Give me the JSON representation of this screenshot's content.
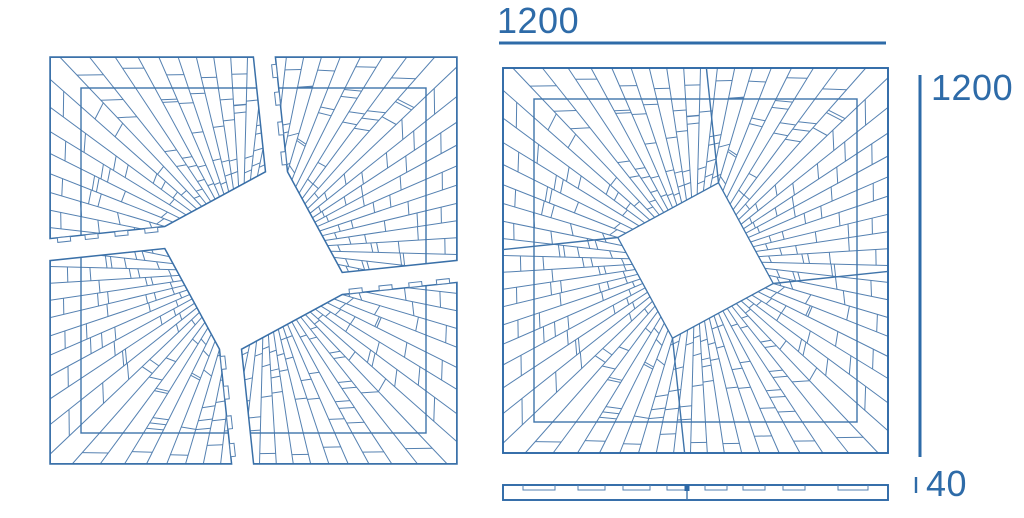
{
  "labels": {
    "dim_width": "1200",
    "dim_height": "1200",
    "dim_thickness": "40"
  },
  "colors": {
    "background": "#ffffff",
    "line_thin": "#5581b1",
    "line_medium": "#3f74aa",
    "line_thick": "#2d68a6",
    "dimension": "#2e6ba8"
  },
  "panel": {
    "size": 385,
    "inner_inset": 31,
    "diamond_angle_deg": 16.5,
    "diamond_corner_radius": 81,
    "ray_step_deg": 5,
    "seam_tilt_deg": 6
  },
  "views": {
    "exploded": {
      "x": 61,
      "y": 68,
      "gap": 11
    },
    "assembled": {
      "x": 503,
      "y": 68
    },
    "side": {
      "x": 503,
      "y": 485,
      "width": 385,
      "height": 15,
      "seam_x": 184,
      "slot_depth": 5,
      "slots": [
        [
          20,
          32
        ],
        [
          75,
          27
        ],
        [
          120,
          27
        ],
        [
          164,
          20
        ],
        [
          202,
          22
        ],
        [
          240,
          22
        ],
        [
          280,
          22
        ],
        [
          335,
          30
        ]
      ]
    }
  },
  "tabs": {
    "length": 13,
    "depth": 4.6,
    "fractions": [
      0.12,
      0.38,
      0.64,
      0.88
    ]
  },
  "dimensions": {
    "top": {
      "line": [
        499,
        43,
        886,
        43
      ],
      "label_x": 497,
      "label_y": 1
    },
    "right": {
      "line": [
        920,
        75,
        920,
        457
      ],
      "label_x": 931,
      "label_y": 68
    },
    "thickness": {
      "tick": [
        916,
        477,
        916,
        493
      ],
      "label_x": 926,
      "label_y": 464
    }
  }
}
